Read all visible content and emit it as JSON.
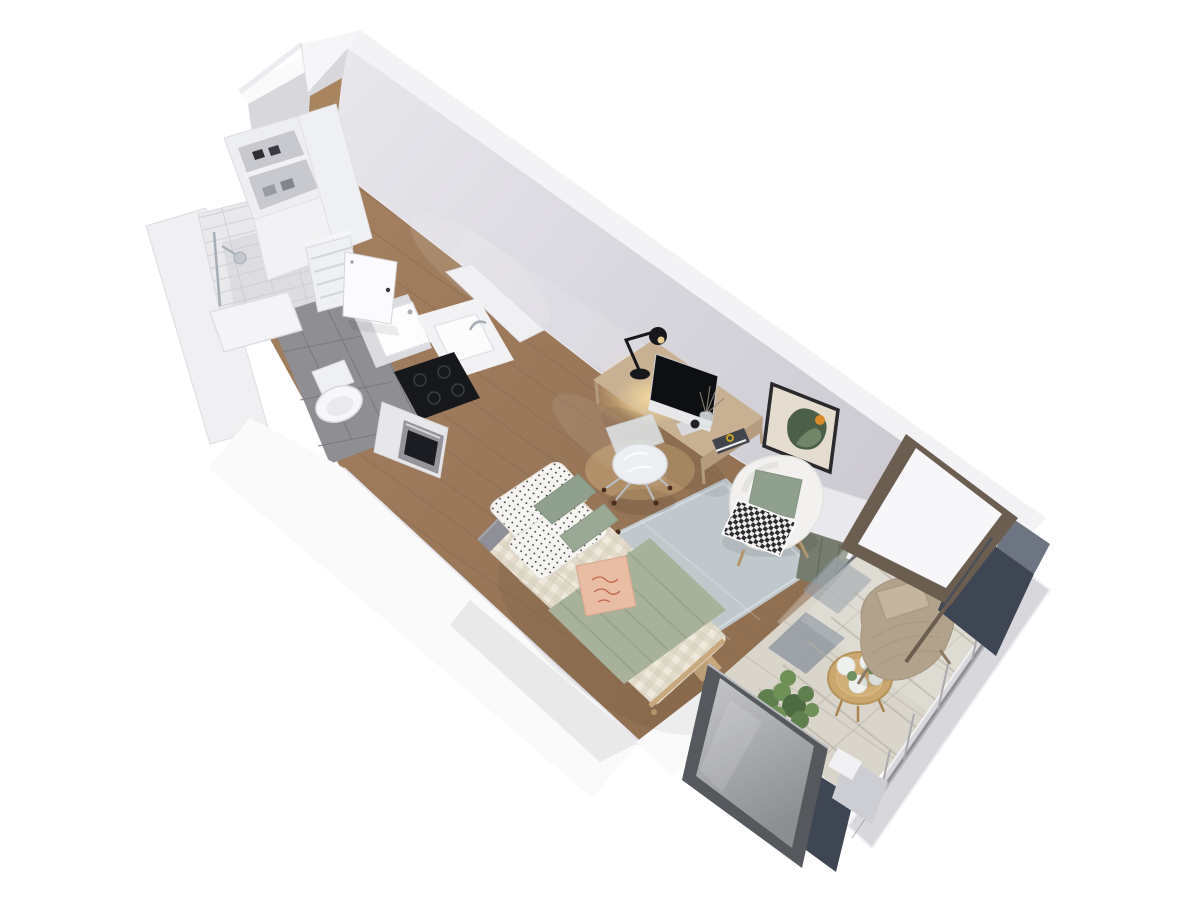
{
  "scene": {
    "type": "3d-floor-plan-render",
    "subject": "studio apartment isometric cutaway",
    "view": "top-down axonometric, apartment runs diagonally from upper-left entry to lower-right balcony",
    "background": "#ffffff"
  },
  "canvas": {
    "width": 1200,
    "height": 900
  },
  "colors": {
    "background": "#ffffff",
    "wall_top": "#f3f3f5",
    "wall_white": "#fafafb",
    "wall_inner": "#d8d7dc",
    "wood_floor": "#9b7b5b",
    "wood_line": "#86684c",
    "bath_tile": "#8e8e93",
    "bath_grout": "#77777d",
    "subway_tile": "#e9e9ec",
    "shower_tray": "#f4f4f6",
    "fixture_white": "#f7f7f9",
    "chrome": "#a7adb5",
    "counter_white": "#f2f2f5",
    "vanity_top": "#dcdce0",
    "cooktop": "#17181c",
    "oven_steel": "#94949a",
    "oven_glass": "#1c1d22",
    "radiator": "#eef0f2",
    "door_white": "#fbfbfd",
    "headboard": "#8f8f97",
    "linen": "#ece7d9",
    "linen_shadow": "#cfc8b6",
    "blanket_sage": "#a8b29b",
    "pillow_sage": "#8fa08e",
    "pillow_sage2": "#9aa996",
    "pillow_peach": "#e9bca4",
    "peach_script": "#b7583f",
    "rug": "#c3ccd3",
    "desk_wood": "#c8b092",
    "desk_edge": "#b59c7f",
    "lamp_black": "#17181b",
    "screen_black": "#0e0f12",
    "monitor_chin": "#e8e8ea",
    "chair_cushion": "#eceff1",
    "art_mat": "#e4ddcf",
    "art_green": "#4c5f49",
    "art_green_light": "#7b8f72",
    "art_orange": "#d98b2b",
    "frame_black": "#2a2a2c",
    "armchair_white": "#f2f1ef",
    "cabinet_top": "#e9e8ec",
    "cabinet_sage": "#767d6f",
    "navy": "#3e4553",
    "navy_top": "#6e7582",
    "bronze": "#6b5e50",
    "glass_white": "#f7f7f9",
    "frost_frame": "#55585c",
    "balcony_tile": "#d9d5cb",
    "tile_line": "#c7c2b6",
    "tile_slate": "#9099a1",
    "shadow_warm": "#b5b0a3",
    "lounge_tan": "#b3a28b",
    "lounge_pillow": "#c5b59e",
    "table_wood": "#c9a76f",
    "flower_white": "#eef0ee",
    "leaf_green": "#6f8f5f",
    "plant_green": "#5f7f4f",
    "railing_gray": "#aaaaaf",
    "glow": "#ffdf9e",
    "track_dark": "#2e3340"
  },
  "inventory": {
    "entry": [
      "entry-door",
      "door-transom-beam",
      "towel-radiator",
      "storage-shelves"
    ],
    "bathroom": [
      "walk-in-shower",
      "shower-fixture",
      "toilet",
      "vanity-basin",
      "gray-tile-floor"
    ],
    "kitchen": [
      "kitchen-sink",
      "faucet",
      "induction-cooktop",
      "oven",
      "kitchen-cabinet"
    ],
    "living_area": [
      "wood-floor",
      "desk",
      "desk-lamp",
      "monitor",
      "desk-chair",
      "wall-art",
      "armchair",
      "throw-blanket",
      "storage-cabinet",
      "bed",
      "pillows",
      "duvet",
      "sage-blanket",
      "rug"
    ],
    "balcony": [
      "sliding-glass-door",
      "tile-floor",
      "lounge-chair",
      "coffee-table",
      "flowers",
      "corner-plant",
      "cable-railing",
      "facade-columns",
      "tilted-window-panel",
      "frosted-glass-panel"
    ]
  }
}
